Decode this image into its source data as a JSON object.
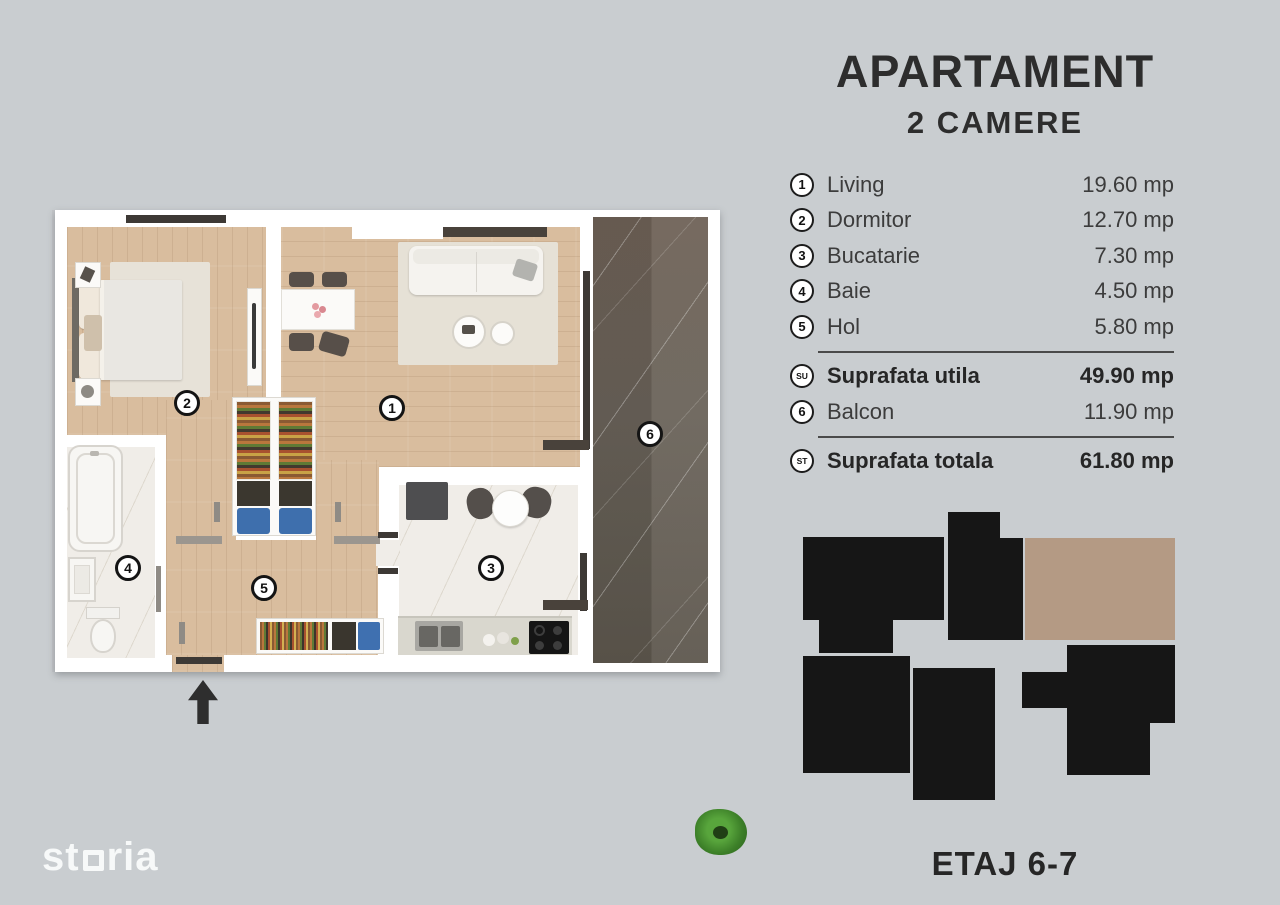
{
  "title": {
    "line1": "APARTAMENT",
    "line2": "2 CAMERE"
  },
  "legend": {
    "rows": [
      {
        "badge": "1",
        "label": "Living",
        "value": "19.60 mp"
      },
      {
        "badge": "2",
        "label": "Dormitor",
        "value": "12.70 mp"
      },
      {
        "badge": "3",
        "label": "Bucatarie",
        "value": "7.30 mp"
      },
      {
        "badge": "4",
        "label": "Baie",
        "value": "4.50 mp"
      },
      {
        "badge": "5",
        "label": "Hol",
        "value": "5.80 mp"
      },
      {
        "badge": "SU",
        "label": "Suprafata utila",
        "value": "49.90 mp"
      },
      {
        "badge": "6",
        "label": "Balcon",
        "value": "11.90 mp"
      },
      {
        "badge": "ST",
        "label": "Suprafata totala",
        "value": "61.80 mp"
      }
    ]
  },
  "floor_label": "ETAJ 6-7",
  "logo": {
    "name": "storia",
    "prefix": "st",
    "suffix": "ria"
  },
  "plan": {
    "badges": [
      "1",
      "2",
      "3",
      "4",
      "5",
      "6"
    ]
  },
  "colors": {
    "background": "#c9cdd0",
    "plan_walls": "#ffffff",
    "wood_floor": "#d9bd9e",
    "tile_floor": "#f0ede8",
    "balcony_floor": "#6e655b",
    "accent_dark": "#3d3935",
    "building_block": "#161616",
    "unit_highlight": "#b49a84",
    "text": "#2d2d2d",
    "logo_text": "#f7f9f9"
  }
}
